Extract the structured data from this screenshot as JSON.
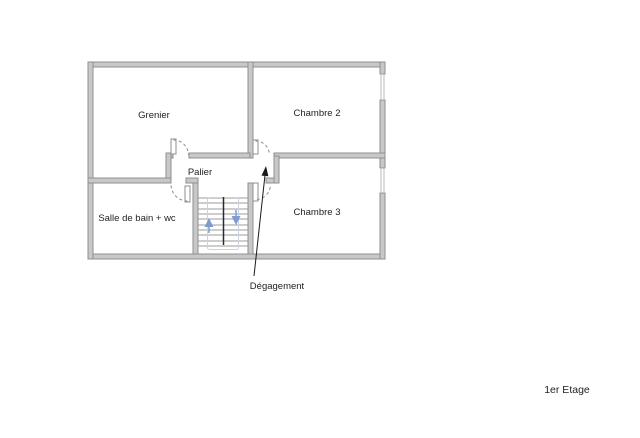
{
  "floor_label": "1er Etage",
  "rooms": [
    {
      "id": "grenier",
      "label": "Grenier"
    },
    {
      "id": "chambre-2",
      "label": "Chambre 2"
    },
    {
      "id": "palier",
      "label": "Palier"
    },
    {
      "id": "salle-de-bain-wc",
      "label": "Salle de bain + wc"
    },
    {
      "id": "chambre-3",
      "label": "Chambre 3"
    }
  ],
  "annotations": [
    {
      "id": "degagement",
      "label": "Dégagement",
      "arrow": "points from label up to the landing passage"
    }
  ],
  "stairs": {
    "up_arrow": "up-flight-arrow",
    "down_arrow": "down-flight-arrow",
    "treads": 10
  },
  "windows": [
    {
      "wall": "right",
      "room": "Chambre 2"
    },
    {
      "wall": "right",
      "room": "Chambre 3"
    }
  ],
  "colors": {
    "background": "#ffffff",
    "wall_fill": "#c8c8c8",
    "wall_edge": "#8f8f8f",
    "door": "#ffffff",
    "window_line": "#b3b9c3",
    "tread": "#9b9b9b",
    "stair_center": "#2b2b2b",
    "walking_line": "#ccd2de",
    "stair_arrow": "#7e9ad2",
    "text": "#222222",
    "arrow": "#1a1a1a"
  }
}
